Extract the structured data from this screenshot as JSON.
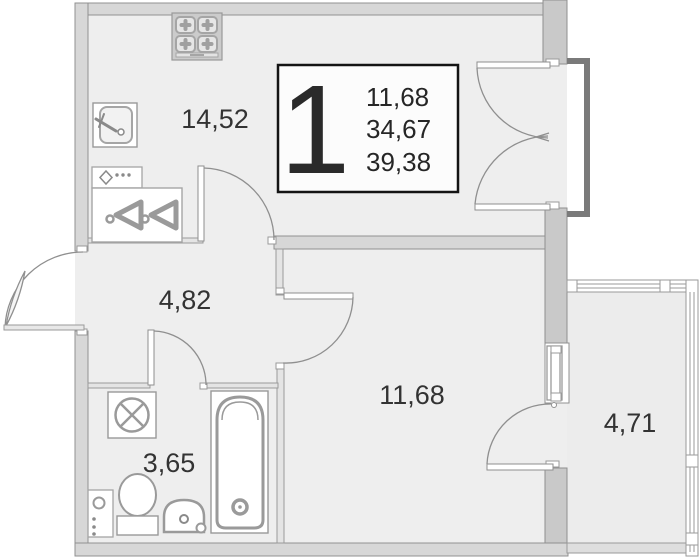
{
  "unit": {
    "number": "1",
    "stats": {
      "row1": "11,68",
      "row2": "34,67",
      "row3": "39,38"
    }
  },
  "rooms": {
    "kitchen": "14,52",
    "hallway": "4,82",
    "bathroom": "3,65",
    "living_room": "11,68",
    "balcony": "4,71"
  },
  "colors": {
    "background": "#ffffff",
    "interior_fill": "#eeeeee",
    "balcony_fill": "#ececec",
    "wall_fill": "#d7d7d7",
    "wall_block_fill": "#c9c9c9",
    "partition_fill": "#e4e4e4",
    "wall_stroke": "#919191",
    "fixture_stroke": "#9a9a9a",
    "rail_color": "#7a7a7a",
    "label_color": "#333333",
    "info_box_border": "#141414"
  },
  "icons": [
    "stove-icon",
    "kitchen-sink-icon",
    "cooktop-panel-icon",
    "wardrobe-hangers-icon",
    "washing-machine-icon",
    "toilet-icon",
    "washbasin-icon",
    "bathtub-icon",
    "towel-rail-icon"
  ]
}
